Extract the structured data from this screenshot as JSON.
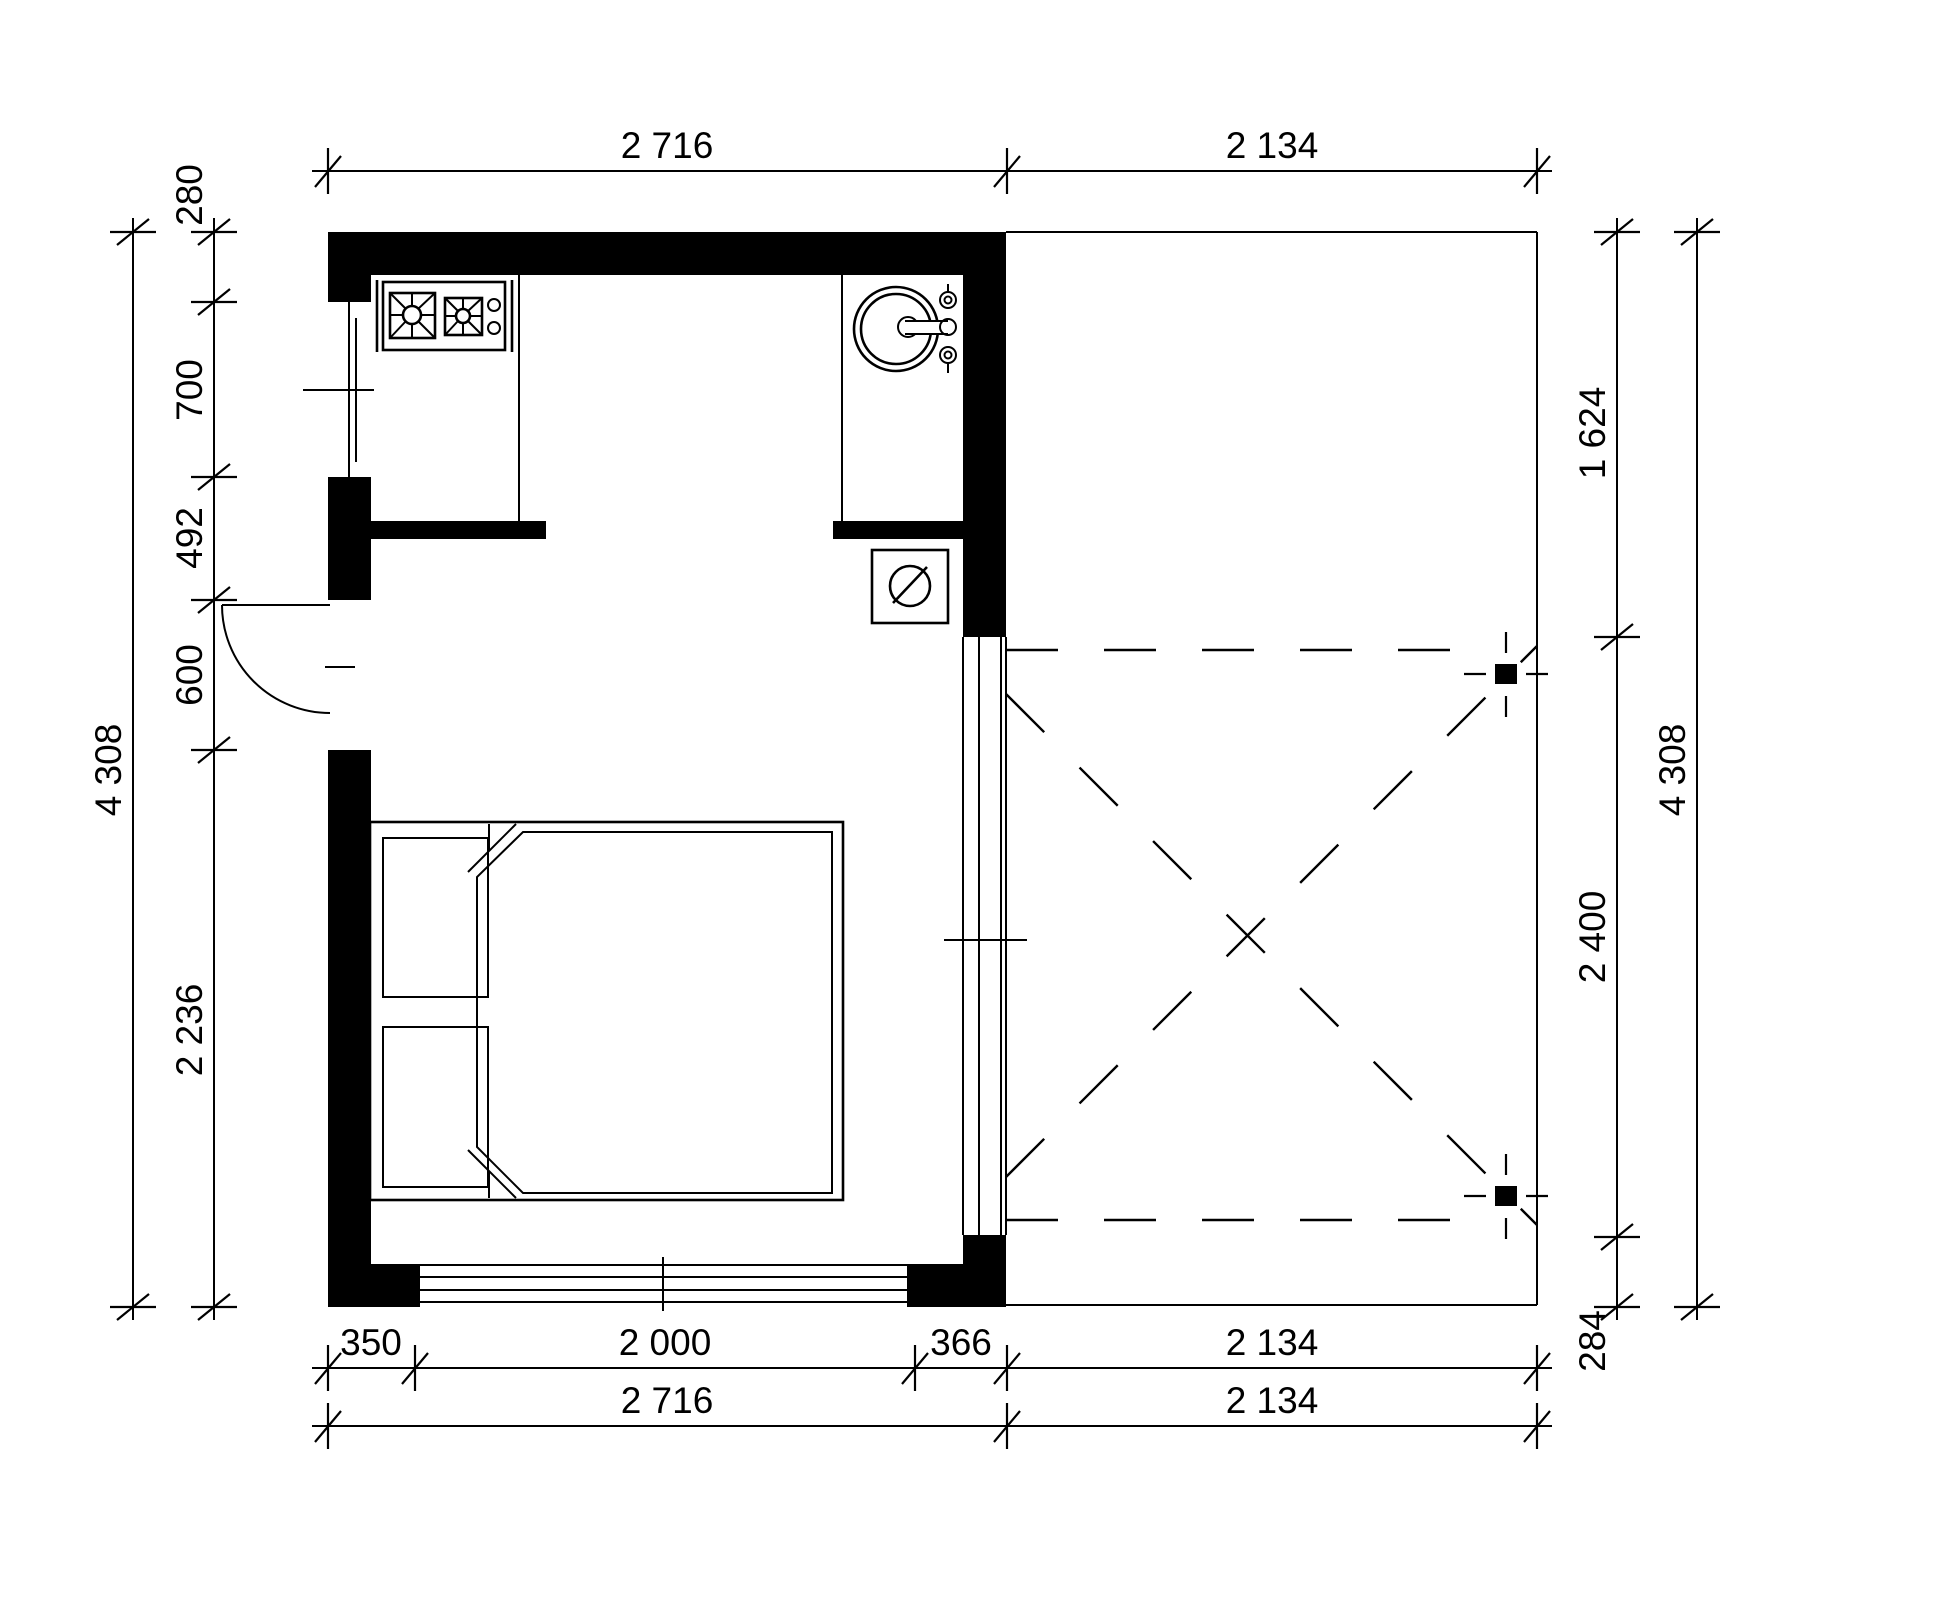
{
  "drawing": {
    "kind": "floor-plan",
    "units": "mm",
    "line_color": "#000000",
    "background_color": "#ffffff",
    "rooms": [
      "kitchen",
      "bedroom",
      "deck"
    ],
    "fixtures": [
      "stove-icon",
      "sink-icon",
      "washing-machine-icon",
      "double-bed",
      "entry-door-swing",
      "sliding-glass-door",
      "deck-posts"
    ]
  },
  "dimensions": {
    "top": {
      "seg1": "2 716",
      "seg2": "2 134"
    },
    "bottom_row1": {
      "seg1": "350",
      "seg2": "2 000",
      "seg3": "366",
      "seg4": "2 134"
    },
    "bottom_row2": {
      "seg1": "2 716",
      "seg2": "2 134"
    },
    "left_inner": {
      "seg1": "280",
      "seg2": "700",
      "seg3": "492",
      "seg4": "600",
      "seg5": "2 236"
    },
    "left_outer": {
      "total": "4 308"
    },
    "right_inner": {
      "seg1": "1 624",
      "seg2": "2 400",
      "seg3": "284"
    },
    "right_outer": {
      "total": "4 308"
    }
  }
}
